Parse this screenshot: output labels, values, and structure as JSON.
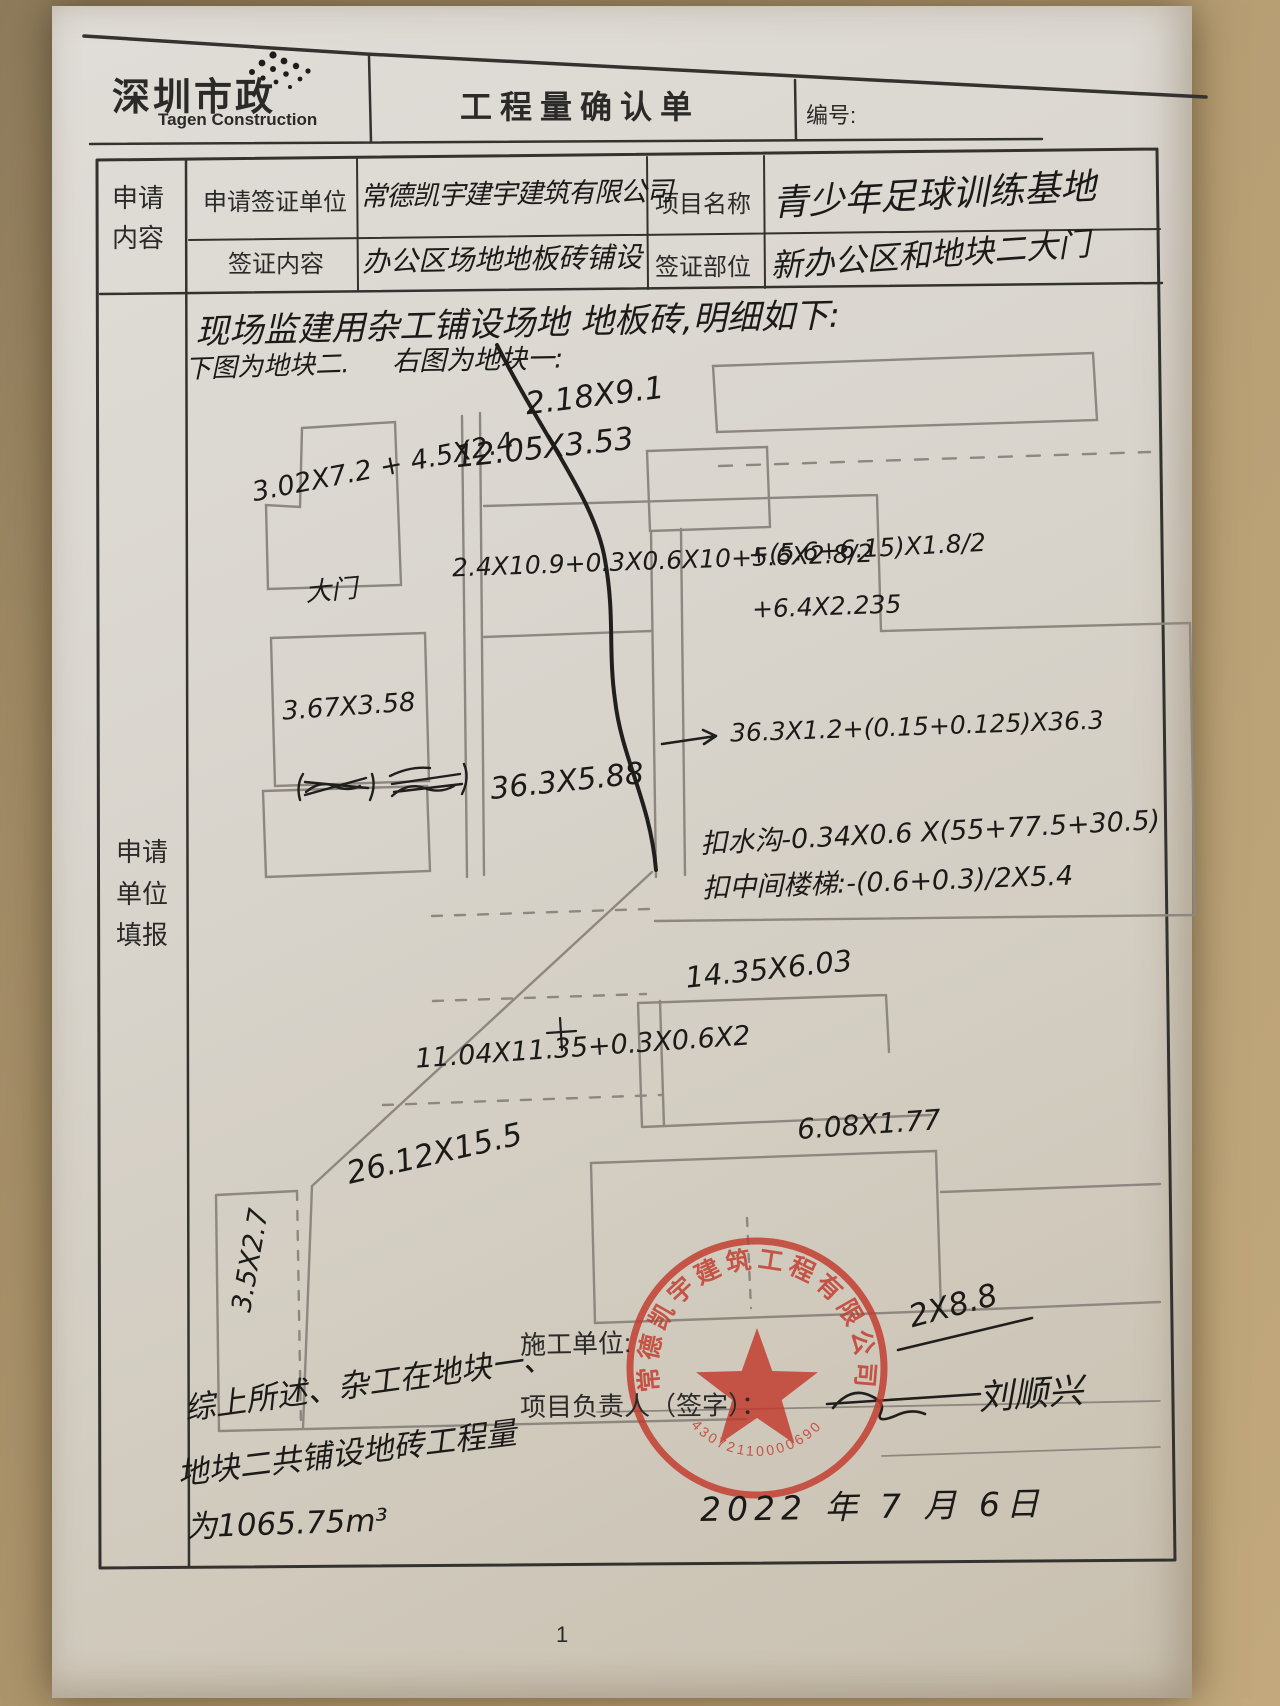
{
  "header": {
    "logo_title": "深圳市政",
    "logo_subtitle": "Tagen Construction",
    "form_title": "工程量确认单",
    "number_label": "编号:"
  },
  "form": {
    "section_label_line1": "申请",
    "section_label_line2": "内容",
    "apply_unit_label": "申请签证单位",
    "apply_unit_value": "常德凯宇建宇建筑有限公司",
    "project_name_label": "项目名称",
    "project_name_value": "青少年足球训练基地",
    "visa_content_label": "签证内容",
    "visa_content_value": "办公区场地地板砖铺设",
    "visa_part_label": "签证部位",
    "visa_part_value": "新办公区和地块二大门",
    "fill_label_line1": "申请",
    "fill_label_line2": "单位",
    "fill_label_line3": "填报"
  },
  "sketch": {
    "intro_line1": "现场监建用杂工铺设场地 地板砖,明细如下:",
    "intro_left": "下图为地块二.",
    "intro_right": "右图为地块一:",
    "gate_label": "大门",
    "m_top_rect": "2.18X9.1",
    "m_row2": "12.05X3.53",
    "m_block2_a": "3.02X7.2 + 4.5X2.4",
    "m_formula_main": "2.4X10.9+0.3X0.6X10+5.6X2.8/2",
    "m_formula_add1": "+(5.6+6.15)X1.8/2",
    "m_formula_add2": "+6.4X2.235",
    "m_block2_b": "3.67X3.58",
    "m_strip": "36.3X5.88",
    "m_arrow_formula": "36.3X1.2+(0.15+0.125)X36.3",
    "m_deduct_ditch": "扣水沟-0.34X0.6 X(55+77.5+30.5)",
    "m_deduct_stairs": "扣中间楼梯:-(0.6+0.3)/2X5.4",
    "m_mid_rect": "14.35X6.03",
    "m_mid_formula": "11.04X11.35+0.3X0.6X2",
    "m_low_rect": "6.08X1.77",
    "m_big_rect": "26.12X15.5",
    "m_small_rect": "3.5X2.7",
    "m_stamp_area": "2X8.8"
  },
  "footer": {
    "conclusion_line1": "综上所述、杂工在地块一、",
    "conclusion_line2": "地块二共铺设地砖工程量",
    "conclusion_line3": "为1065.75m³",
    "construction_unit_label": "施工单位:",
    "manager_label": "项目负责人（签字）：",
    "manager_signature": "刘顺兴",
    "date": "2022 年 7 月 6日"
  },
  "stamp": {
    "company": "常德凯宇建筑工程有限公司",
    "serial": "43072110000690"
  },
  "page_number": "1"
}
